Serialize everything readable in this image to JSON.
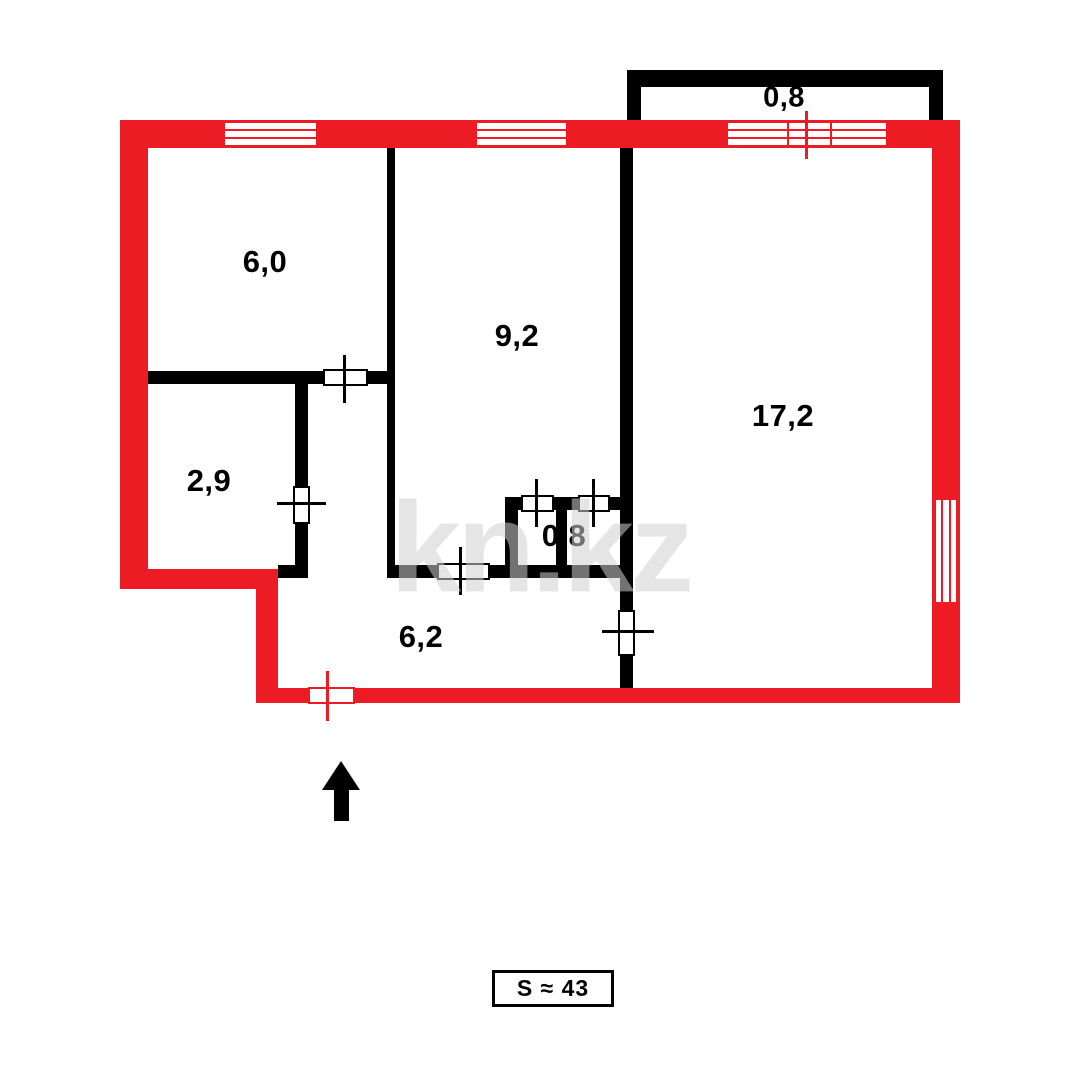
{
  "floorplan": {
    "watermark": "kn.kz",
    "total_area_label": "S ≈ 43",
    "balcony": {
      "area": "0,8"
    },
    "rooms": [
      {
        "name": "top-left-room",
        "area": "6,0"
      },
      {
        "name": "middle-room",
        "area": "9,2"
      },
      {
        "name": "right-room",
        "area": "17,2"
      },
      {
        "name": "lower-left-room",
        "area": "2,9"
      },
      {
        "name": "bathroom",
        "area": "0,8"
      },
      {
        "name": "hallway",
        "area": "6,2"
      }
    ],
    "north_arrow_direction": "up",
    "colors": {
      "exterior_wall": "#ed1c24",
      "interior_wall": "#000000",
      "watermark_gray": "#d0d0d0"
    }
  }
}
